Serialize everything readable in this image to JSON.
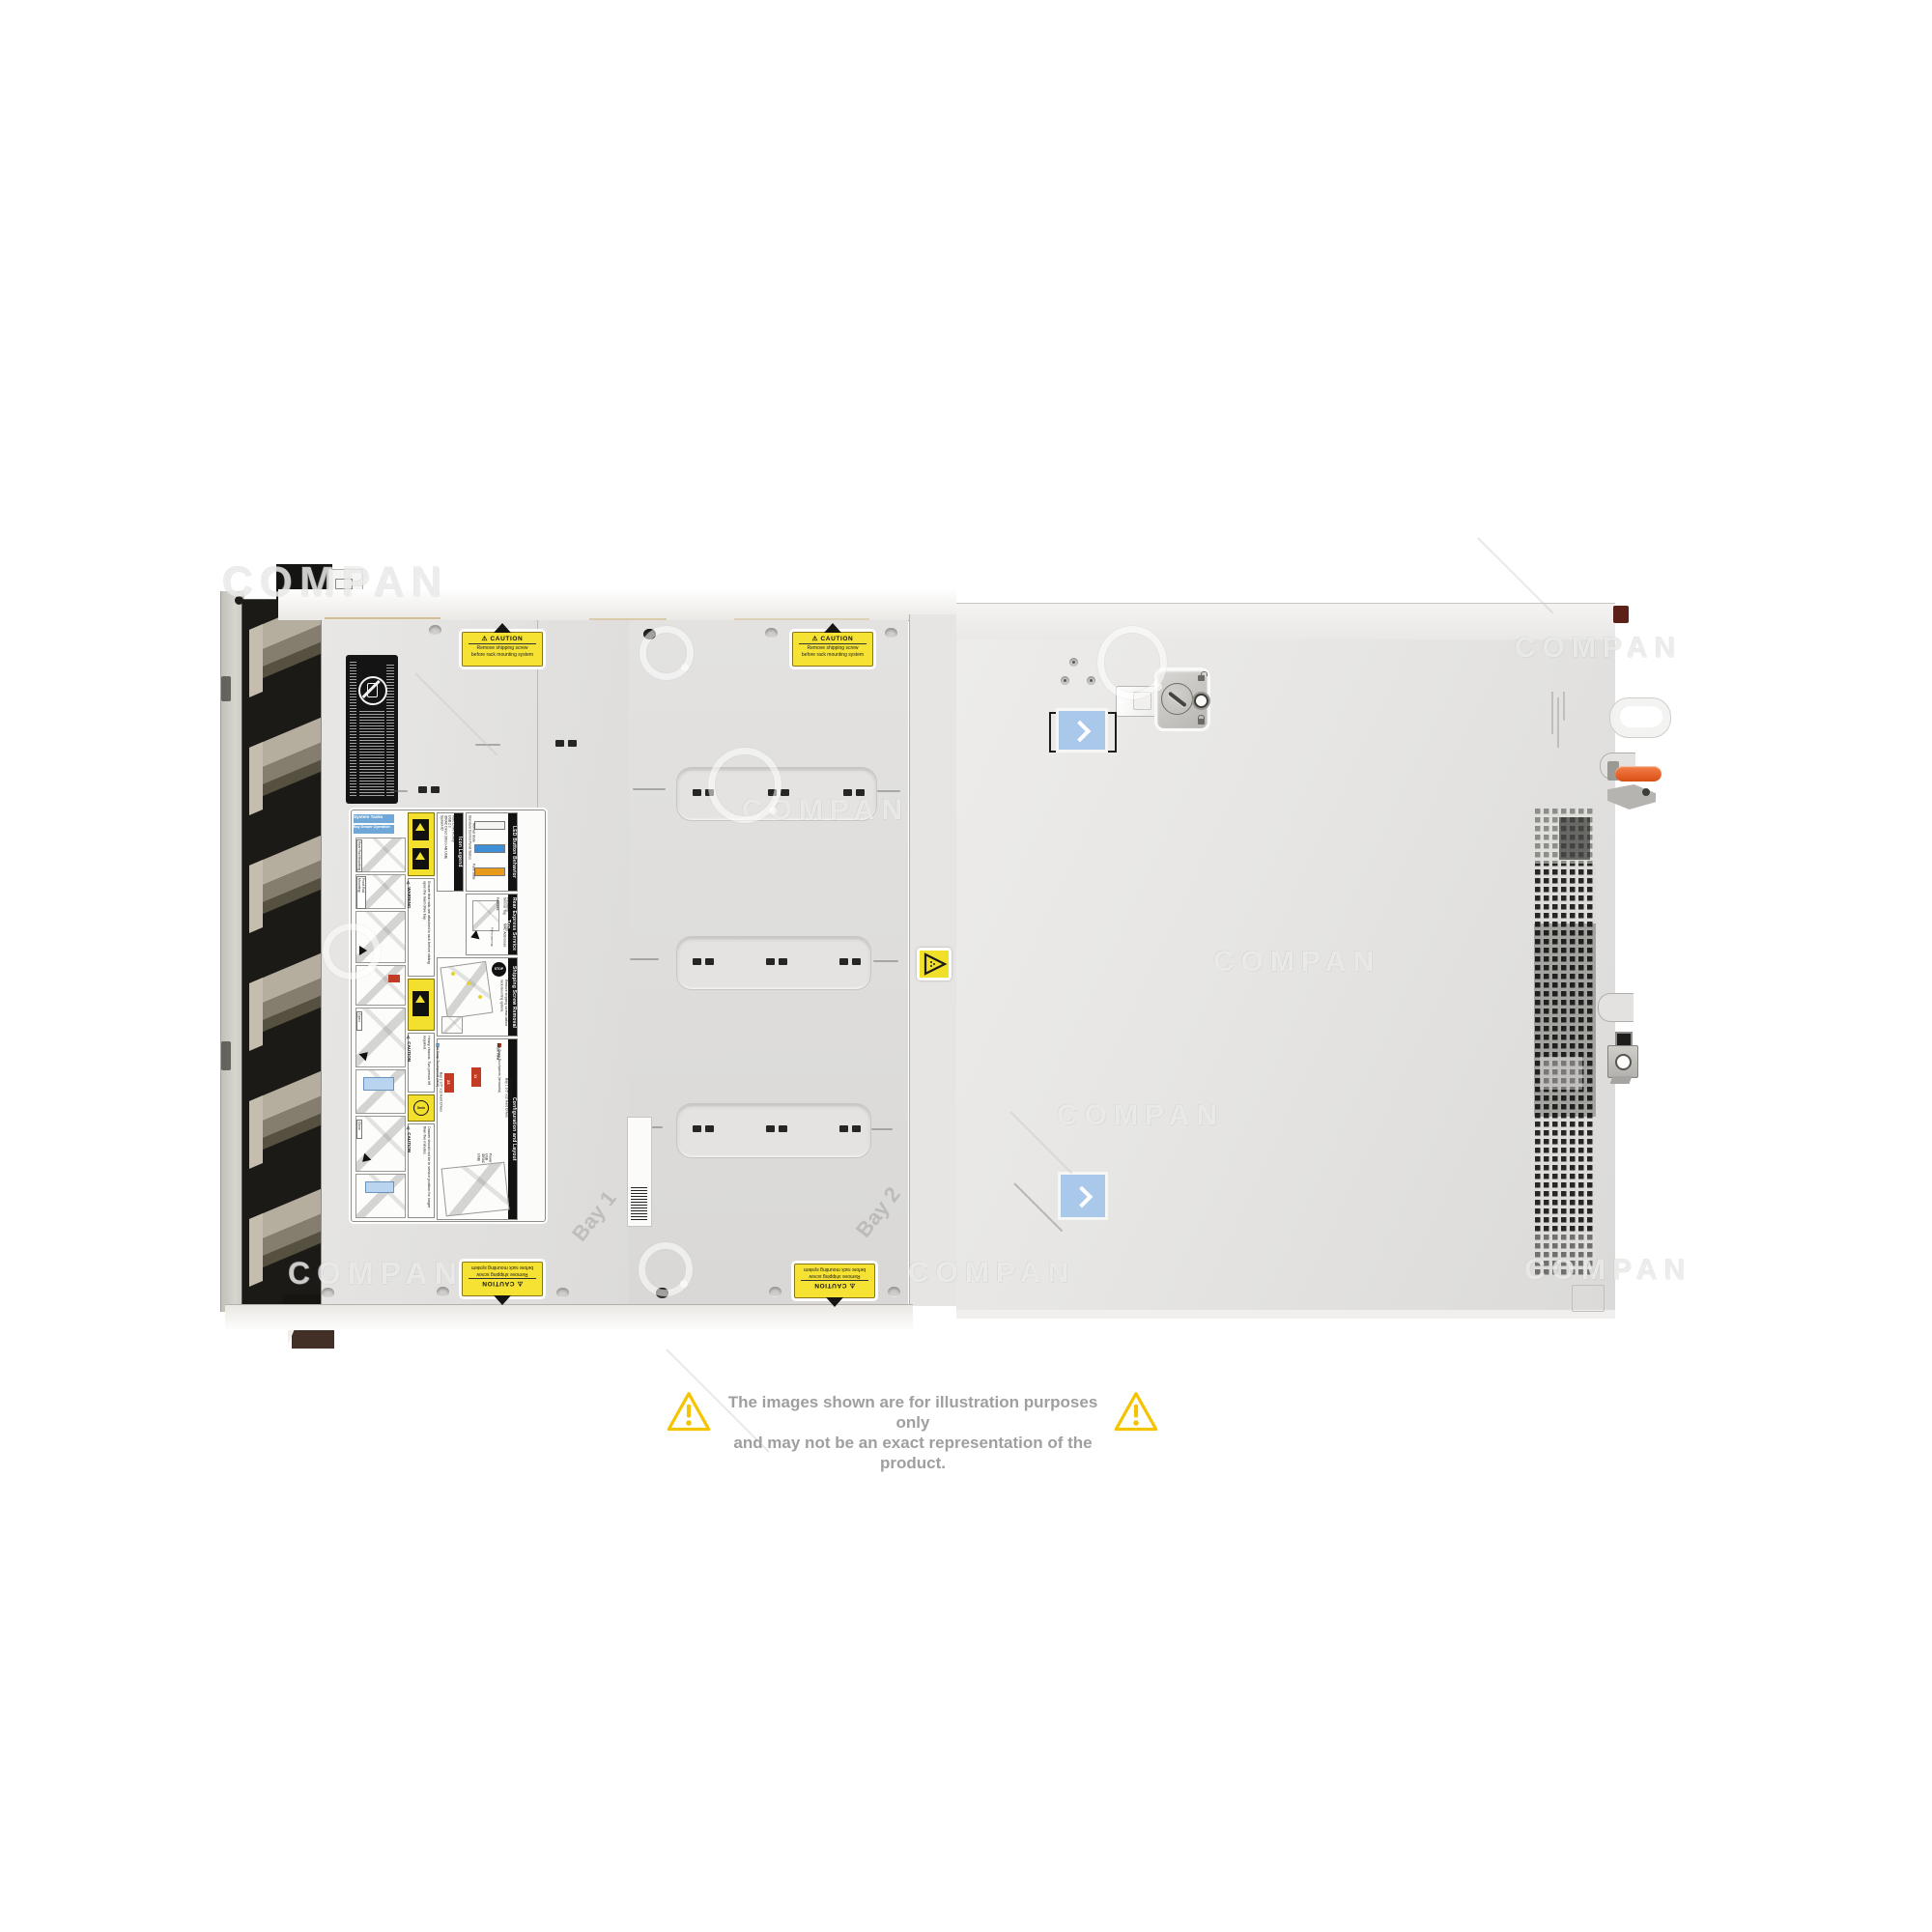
{
  "watermark": {
    "text": "COMPAN"
  },
  "disclaimer": {
    "line1": "The images shown are for illustration purposes only",
    "line2": "and may not be an exact representation of the product."
  },
  "stickers": {
    "caution": {
      "title": "⚠ CAUTION",
      "line1": "Remove shipping screw",
      "line2": "before rack mounting system"
    }
  },
  "embossed": {
    "bay1": "Bay 1",
    "bay2": "Bay 2"
  },
  "service_label": {
    "system_tasks": "System Tasks",
    "bay_drawer_operation": "Bay Drawer Operation",
    "steps": {
      "rear_rail": "Rear Rail Mounting",
      "front_rail": "Front Rail Mounting",
      "open": "Open",
      "close": "Close"
    },
    "warning": {
      "title": "⚠ WARNING",
      "text": "Ensure that rails are attached to rack before sliding open the hard drive bay."
    },
    "icon_legend": {
      "title": "Icon Legend",
      "items": [
        "System ID",
        "iDRAC Direct (Micro-AB USB)",
        "USB 2.0",
        "Hard Drive Activity"
      ]
    },
    "led_button": {
      "title": "LED Button Behavior",
      "subtitle": "Standard Control Panel Status",
      "normal": "Normal State",
      "fault": "Fault State"
    },
    "rear_tag": {
      "title": "Rear Express Service Tag",
      "features_label": "Features:",
      "features": [
        "Service Tag",
        "Password",
        "MAC Addresses",
        "Express Service Code"
      ],
      "pull": "Pull to open tag"
    },
    "shipping": {
      "title": "Shipping Screw Removal",
      "stop": "STOP",
      "text": "Remove shipping screws before rack mounting system."
    },
    "caution_heavy": {
      "title": "⚠ CAUTION",
      "text": "Heavy chassis. Two person lift required."
    },
    "caution_drawer": {
      "title": "⚠ CAUTION",
      "badge": "5min",
      "text": "Drawer should not be in service position for longer than five minutes."
    },
    "config": {
      "title": "Configuration and Layout",
      "hot": "Hot Swap Touchpoints (terracotta)",
      "cold": "Cold Swap Touchpoints (blue)",
      "front_view": "Front View",
      "bay1": "Bay 1 3.5\" x12 Hard Drives",
      "bay2": "Bay 2 3.5\" x12 Hard Drives",
      "light_bar": "System ID/Status Light Bar",
      "idrac": "iDRAC Direct (Micro-AB USB)",
      "usb": "USB",
      "power": "Power",
      "bay1_drives": [
        0,
        1,
        2,
        3,
        4,
        5,
        6,
        7,
        8,
        9,
        10,
        11
      ],
      "bay2_drives": [
        12,
        13,
        14,
        15,
        16,
        17,
        18,
        19,
        20,
        21,
        22,
        23
      ]
    }
  }
}
